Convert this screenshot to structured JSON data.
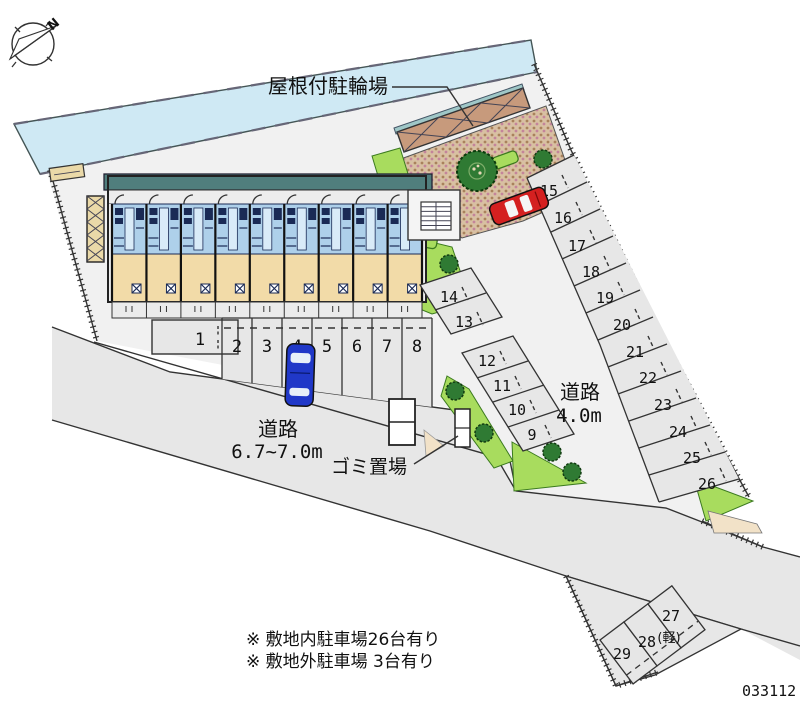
{
  "compass": {
    "north_label": "N"
  },
  "labels": {
    "bike_shelter": "屋根付駐輪場",
    "garbage_area": "ゴミ置場",
    "road_southwest": {
      "name": "道路",
      "width": "6.7~7.0m"
    },
    "road_east": {
      "name": "道路",
      "width": "4.0m"
    },
    "kei_car": "(軽)"
  },
  "stalls": {
    "front": [
      "1",
      "2",
      "3",
      "4",
      "5",
      "6",
      "7",
      "8"
    ],
    "middle": [
      "9",
      "10",
      "11",
      "12",
      "13",
      "14"
    ],
    "east": [
      "15",
      "16",
      "17",
      "18",
      "19",
      "20",
      "21",
      "22",
      "23",
      "24",
      "25",
      "26"
    ],
    "south": [
      "27",
      "28",
      "29"
    ]
  },
  "notes": [
    "※ 敷地内駐車場26台有り",
    "※ 敷地外駐車場 3台有り"
  ],
  "plan_number": "033112",
  "colors": {
    "water": "#cfe9f4",
    "roof": "#507e7d",
    "unit_blue": "#aed0ea",
    "unit_tan": "#f2dba8",
    "lawn": "#a8dc5e",
    "tree": "#2f7a33",
    "canopy": "#c79a7c",
    "road": "#e7e7e7",
    "site": "#f1f1f1",
    "car_blue": "#2038c8",
    "car_red": "#d42020"
  }
}
